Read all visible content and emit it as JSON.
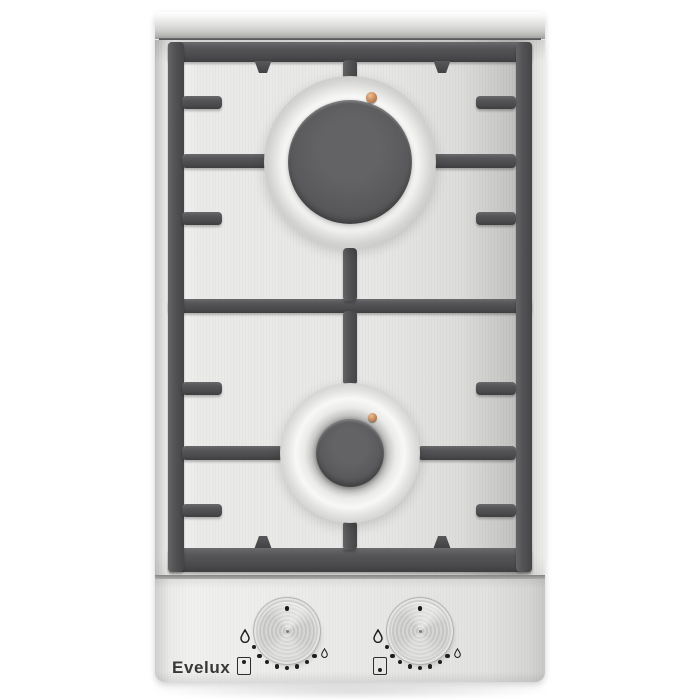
{
  "branding": {
    "logo_text": "Evelux"
  },
  "hob": {
    "burner_count": 2,
    "rear_burner": {
      "size": "large",
      "grate_fingers": 4,
      "has_ignition_electrode": true
    },
    "front_burner": {
      "size": "small",
      "grate_fingers": 4,
      "has_ignition_electrode": true
    },
    "colors": {
      "background": "#ffffff",
      "stainless_surface": "#e9e9e7",
      "grate": "#4e4e50",
      "burner_cap": "#57575a",
      "burner_ring": "#ececea",
      "electrode_copper": "#c0845a",
      "markings": "#1f1f1f"
    }
  },
  "controls": {
    "knobs": [
      {
        "name": "rear-burner-knob",
        "controls_burner": "rear",
        "state": "off",
        "icons": {
          "max": "flame-max-icon",
          "min": "flame-min-icon",
          "burner_position": "burner-rear-indicator-icon"
        },
        "level_dots": 8
      },
      {
        "name": "front-burner-knob",
        "controls_burner": "front",
        "state": "off",
        "icons": {
          "max": "flame-max-icon",
          "min": "flame-min-icon",
          "burner_position": "burner-front-indicator-icon"
        },
        "level_dots": 8
      }
    ]
  }
}
